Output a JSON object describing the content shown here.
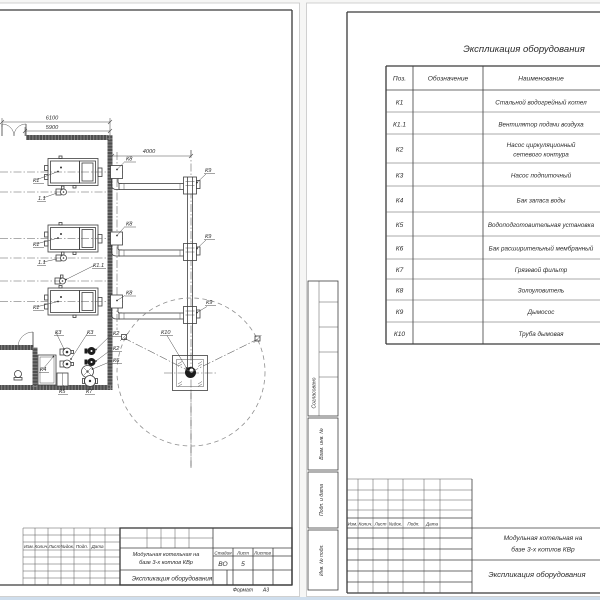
{
  "plan_sheet": {
    "dims": {
      "d6100": "6100",
      "d5900": "5900",
      "d4000": "4000"
    },
    "labels": {
      "k1": "К1",
      "k11_short": "1.1",
      "k11": "К1.1",
      "k2": "К2",
      "k3": "К3",
      "k4": "К4",
      "k5": "К5",
      "k6": "К6",
      "k7": "К7",
      "k8": "К8",
      "k9": "К9",
      "k10": "К10"
    },
    "title_block": {
      "project_line1": "Модульная котельная на",
      "project_line2": "базе 3-х котлов КВр",
      "doc_title": "Экспликация оборудования",
      "stage_label": "Стадия",
      "sheet_label": "Лист",
      "sheets_label": "Листов",
      "stage": "ВО",
      "sheet_no": "5",
      "format_label": "Формат",
      "format_value": "А3",
      "rev_cols": [
        "Изм.",
        "Колич.",
        "Лист",
        "№док.",
        "Подп.",
        "Дата"
      ]
    }
  },
  "spec_sheet": {
    "title": "Экспликация оборудования",
    "table": {
      "headers": [
        "Поз.",
        "Обозначение",
        "Наименование"
      ],
      "rows": [
        {
          "pos": "К1",
          "name": "Стальной водогрейный котел"
        },
        {
          "pos": "К1.1",
          "name": "Вентилятор подачи воздуха"
        },
        {
          "pos": "К2",
          "name_line1": "Насос циркуляционный",
          "name_line2": "сетевого контура"
        },
        {
          "pos": "К3",
          "name": "Насос подпиточный"
        },
        {
          "pos": "К4",
          "name": "Бак запаса воды"
        },
        {
          "pos": "К5",
          "name": "Водоподготовительная установка"
        },
        {
          "pos": "К6",
          "name": "Бак расширительный мембранный"
        },
        {
          "pos": "К7",
          "name": "Грязевой фильтр"
        },
        {
          "pos": "К8",
          "name": "Золоуловитель"
        },
        {
          "pos": "К9",
          "name": "Дымосос"
        },
        {
          "pos": "К10",
          "name": "Труба дымовая"
        }
      ]
    },
    "margin_labels": [
      "Согласовано",
      "Взам. инв. №",
      "Подп. и дата",
      "Инв. № подл."
    ],
    "title_block": {
      "project_line1": "Модульная котельная на",
      "project_line2": "базе 3-х котлов КВр",
      "doc_title": "Экспликация оборудования",
      "rev_cols": [
        "Изм.",
        "Колич.",
        "Лист",
        "№док.",
        "Подп.",
        "Дата"
      ]
    }
  }
}
